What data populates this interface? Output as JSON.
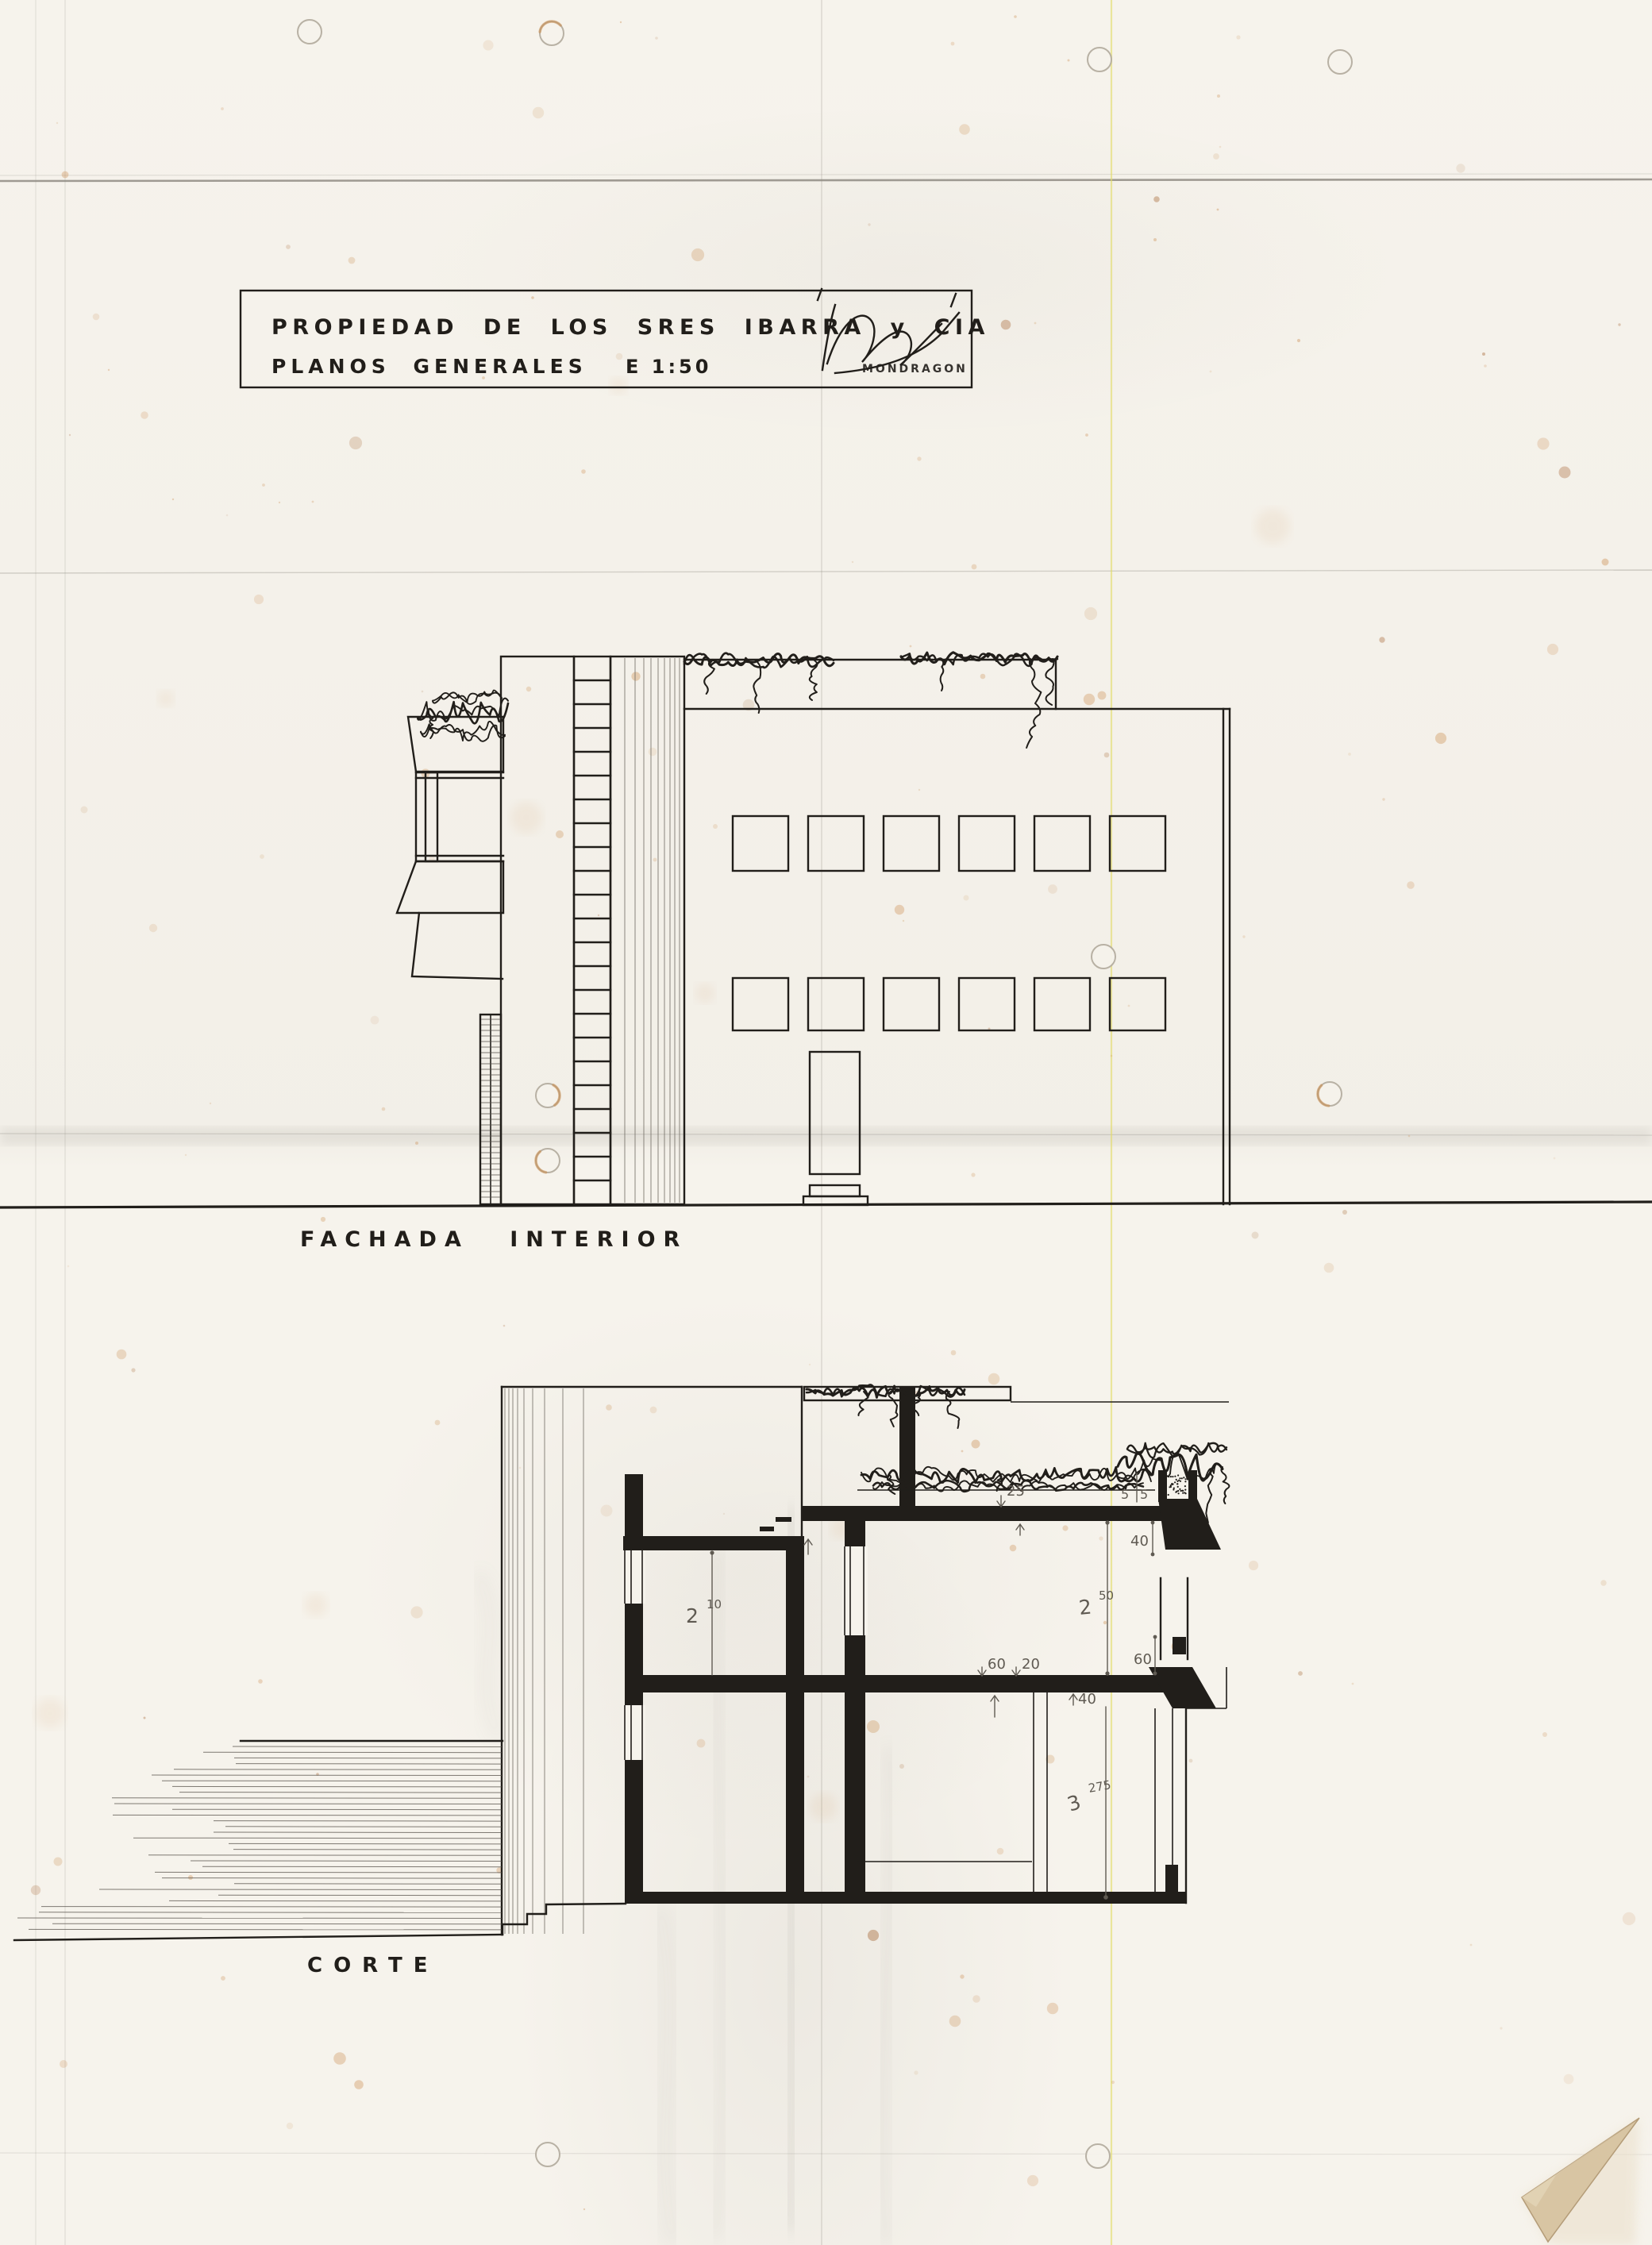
{
  "colors": {
    "paper": "#f6f3ec",
    "ink": "#211e1a",
    "pencil": "#5f5a52",
    "stain": "#c98a4b",
    "yellow": "#e3dc66",
    "corner": "#d8c5a3",
    "hole": "#b5aea1",
    "fold": "#8f8b83"
  },
  "title_block": {
    "line1": "PROPIEDAD DE LOS SRES IBARRA y CIA",
    "line2": "PLANOS GENERALES",
    "scale_label": "E 1:50",
    "signature_name": "MONDRAGON"
  },
  "facade": {
    "label": "FACHADA INTERIOR"
  },
  "section": {
    "label": "CORTE",
    "dims": {
      "upper_left_m": "2",
      "upper_left_s": "10",
      "upper_right_m": "2",
      "upper_right_s": "50",
      "lower_m": "3",
      "lower_s": "275",
      "slab_top": "25",
      "parapet_a": "5",
      "parapet_b": "5",
      "beam": "40",
      "sill": "60",
      "slab_60": "60",
      "slab_20": "20",
      "slab_40": "40"
    }
  }
}
